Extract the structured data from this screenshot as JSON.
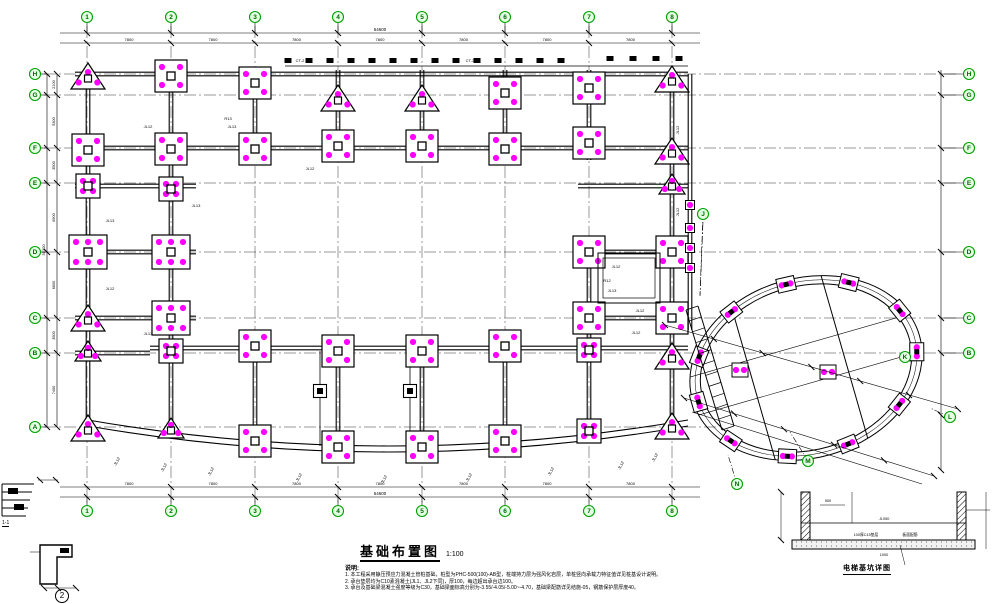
{
  "title": {
    "text": "基础布置图",
    "scale": "1:100"
  },
  "notes": {
    "header": "说明:",
    "items": [
      "1. 本工程采用静压预应力混凝土管桩基础，桩型为PHC-500(100)-AB型，桩端持力层为强风化岩层，单桩竖向承载力特征值详见桩基设计说明。",
      "2. 承台垫层均为C10素混凝土(JL1、JL2下同)，厚100，每边超出承台边100。",
      "3. 承台及基础梁混凝土强度等级为C30，基础梁面标高分别为-3.55/-4.05/-5.00~-4.70，基础梁配筋详见结施-05，钢筋保护层厚度40。"
    ]
  },
  "details": {
    "pit_title": "电梯基坑详图",
    "detail1_label": "1-1",
    "detail2_label": "2",
    "pit_labels": [
      "500",
      "-5.050",
      "100厚C15垫层",
      "板面配筋",
      "1000"
    ]
  },
  "colors": {
    "line": "#000000",
    "grid": "#333333",
    "pile": "#ff00ff",
    "bubble_stroke": "#00a000",
    "bubble_fill": "#e4ffe4",
    "bubble_text": "#006600"
  },
  "grid": {
    "cols": [
      {
        "label": "1",
        "x": 87
      },
      {
        "label": "2",
        "x": 171
      },
      {
        "label": "3",
        "x": 255
      },
      {
        "label": "4",
        "x": 338
      },
      {
        "label": "5",
        "x": 422
      },
      {
        "label": "6",
        "x": 505
      },
      {
        "label": "7",
        "x": 589
      },
      {
        "label": "8",
        "x": 672
      }
    ],
    "rows": [
      {
        "label": "H",
        "y": 74
      },
      {
        "label": "G",
        "y": 95
      },
      {
        "label": "F",
        "y": 148
      },
      {
        "label": "E",
        "y": 183
      },
      {
        "label": "D",
        "y": 252
      },
      {
        "label": "C",
        "y": 318
      },
      {
        "label": "B",
        "y": 353
      },
      {
        "label": "A",
        "y": 427
      }
    ]
  },
  "dims": {
    "top_total": "54600",
    "bay": "7800",
    "bottom_total": "54600",
    "left_total": "35300",
    "left_values": [
      "2100",
      "5300",
      "3500",
      "6900",
      "6600",
      "3500",
      "7400"
    ]
  },
  "caps": [
    [
      88,
      76,
      "tri"
    ],
    [
      171,
      76,
      "sq4"
    ],
    [
      255,
      83,
      "sq4"
    ],
    [
      338,
      98,
      "tri"
    ],
    [
      422,
      98,
      "tri"
    ],
    [
      505,
      93,
      "sq4"
    ],
    [
      589,
      88,
      "sq4"
    ],
    [
      672,
      79,
      "tri"
    ],
    [
      88,
      150,
      "sq4"
    ],
    [
      171,
      149,
      "sq4"
    ],
    [
      255,
      149,
      "sq4"
    ],
    [
      338,
      146,
      "sq4"
    ],
    [
      422,
      146,
      "sq4"
    ],
    [
      505,
      149,
      "sq4"
    ],
    [
      589,
      143,
      "sq4"
    ],
    [
      672,
      151,
      "tri"
    ],
    [
      88,
      186,
      "sq4s"
    ],
    [
      171,
      189,
      "sq4s"
    ],
    [
      672,
      184,
      "tris"
    ],
    [
      88,
      252,
      "sq6"
    ],
    [
      171,
      252,
      "sq6"
    ],
    [
      589,
      252,
      "sq4"
    ],
    [
      672,
      252,
      "sq4"
    ],
    [
      88,
      318,
      "tri"
    ],
    [
      171,
      318,
      "sq6"
    ],
    [
      589,
      318,
      "sq4"
    ],
    [
      672,
      318,
      "sq4"
    ],
    [
      88,
      351,
      "tris"
    ],
    [
      171,
      351,
      "sq4s"
    ],
    [
      672,
      356,
      "tri"
    ],
    [
      255,
      346,
      "sq4"
    ],
    [
      338,
      351,
      "sq4"
    ],
    [
      422,
      351,
      "sq4"
    ],
    [
      505,
      346,
      "sq4"
    ],
    [
      589,
      350,
      "sq4s"
    ],
    [
      320,
      391,
      "sm"
    ],
    [
      410,
      391,
      "sm"
    ],
    [
      88,
      428,
      "tri"
    ],
    [
      171,
      428,
      "tris"
    ],
    [
      255,
      441,
      "sq4"
    ],
    [
      338,
      447,
      "sq4"
    ],
    [
      422,
      447,
      "sq4"
    ],
    [
      505,
      441,
      "sq4"
    ],
    [
      589,
      431,
      "sq4s"
    ],
    [
      672,
      426,
      "tri"
    ],
    [
      690,
      205,
      "dot"
    ],
    [
      690,
      228,
      "dot"
    ],
    [
      690,
      248,
      "dot"
    ],
    [
      690,
      268,
      "dot"
    ]
  ],
  "beam_labels": [
    [
      148,
      128,
      "JL12",
      0
    ],
    [
      232,
      128,
      "JL13",
      0
    ],
    [
      310,
      170,
      "JL12",
      0
    ],
    [
      196,
      207,
      "JL13",
      0
    ],
    [
      110,
      222,
      "JL13",
      0
    ],
    [
      110,
      290,
      "JL12",
      0
    ],
    [
      148,
      335,
      "JL13",
      0
    ],
    [
      616,
      268,
      "JL12",
      0
    ],
    [
      612,
      292,
      "JL13",
      0
    ],
    [
      640,
      312,
      "JL12",
      0
    ],
    [
      636,
      334,
      "JL12",
      0
    ],
    [
      679,
      130,
      "JL12",
      -90
    ],
    [
      679,
      212,
      "JL12",
      -90
    ],
    [
      300,
      62,
      "CT-2",
      0
    ],
    [
      470,
      62,
      "CT-2",
      0
    ],
    [
      228,
      120,
      "R13",
      0
    ],
    [
      118,
      462,
      "JL12",
      -60
    ],
    [
      165,
      468,
      "JL12",
      -60
    ],
    [
      212,
      472,
      "JL12",
      -60
    ],
    [
      300,
      478,
      "JL12",
      -60
    ],
    [
      385,
      480,
      "JL12",
      -60
    ],
    [
      470,
      478,
      "JL12",
      -60
    ],
    [
      552,
      472,
      "JL12",
      -60
    ],
    [
      622,
      466,
      "JL12",
      -60
    ],
    [
      656,
      458,
      "JL12",
      -60
    ],
    [
      607,
      282,
      "R12",
      0
    ]
  ],
  "annex": {
    "cx": 806,
    "cy": 368,
    "rx": 118,
    "ry": 90,
    "rot": -16,
    "cap_angles": [
      10,
      45,
      80,
      112,
      145,
      178,
      208,
      240,
      272,
      305,
      340
    ],
    "bubbles": [
      {
        "label": "J",
        "x": 703,
        "y": 214,
        "tx": 700,
        "ty": 295
      },
      {
        "label": "K",
        "x": 905,
        "y": 357,
        "tx": 0,
        "ty": 0
      },
      {
        "label": "L",
        "x": 950,
        "y": 417,
        "tx": 930,
        "ty": 408
      },
      {
        "label": "M",
        "x": 808,
        "y": 461,
        "tx": 790,
        "ty": 432
      },
      {
        "label": "N",
        "x": 737,
        "y": 484,
        "tx": 728,
        "ty": 455
      }
    ]
  }
}
